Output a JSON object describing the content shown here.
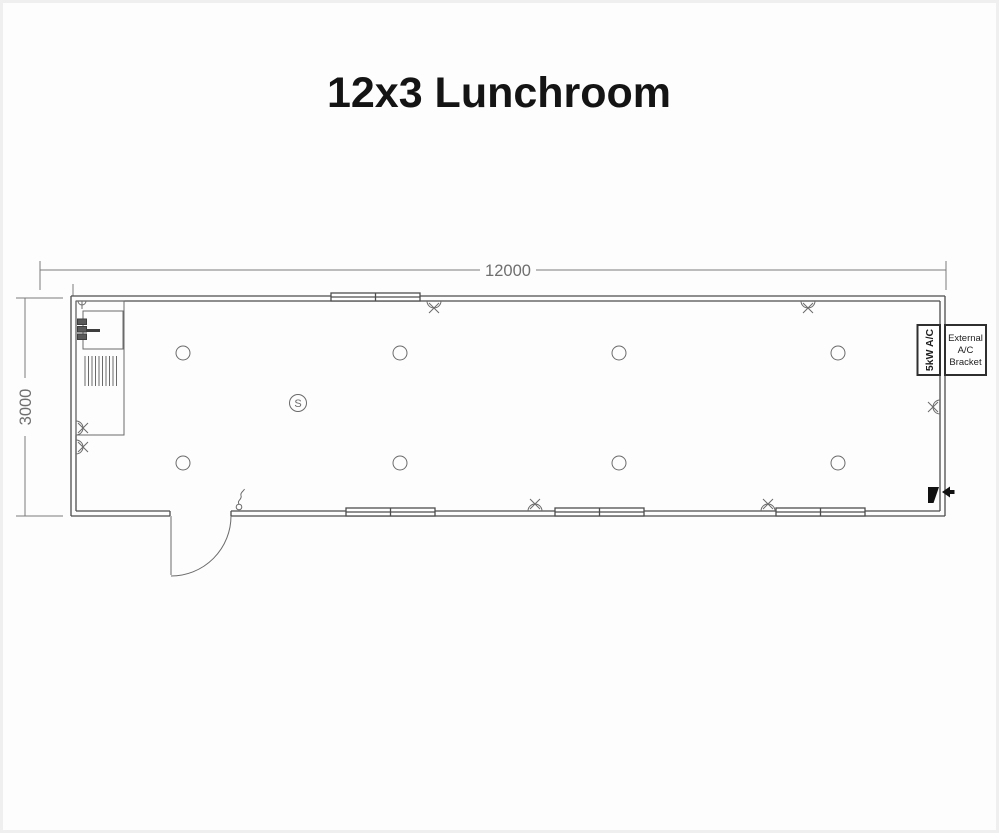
{
  "title": "12x3 Lunchroom",
  "dimensions": {
    "width_label": "12000",
    "height_label": "3000"
  },
  "ac_unit": {
    "label": "5kW A/C"
  },
  "ac_bracket": {
    "line1": "External",
    "line2": "A/C",
    "line3": "Bracket"
  },
  "smoke_detector": {
    "label": "S"
  },
  "legend": {
    "circle_symbol": "ceiling-downlight",
    "x_symbol": "double-power-point",
    "s_symbol": "smoke-detector",
    "squiggle_symbol": "light-switch",
    "black_arrow_symbol": "power-inlet",
    "hatch_symbol": "sink-drainer",
    "double_line_band": "window",
    "arc_symbol": "door-swing"
  },
  "colors": {
    "plan_line": "#4d4d4d",
    "dimension_line": "#7a7a7a",
    "title_text": "#141414",
    "background": "#fdfdfd"
  }
}
